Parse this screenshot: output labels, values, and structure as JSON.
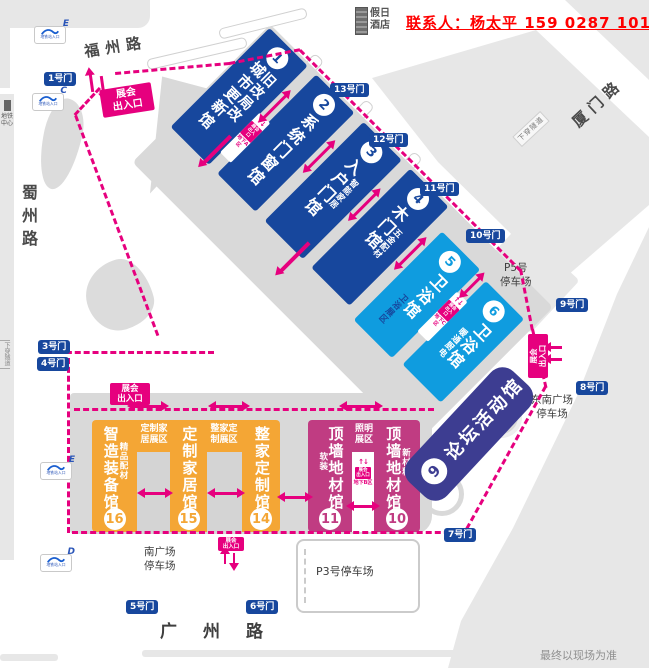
{
  "colors": {
    "hall_dark_blue": "#17479d",
    "hall_light_blue": "#0f9cdf",
    "hall_indigo": "#3d3d91",
    "hall_magenta": "#c03c82",
    "hall_orange": "#f4a635",
    "accent_pink": "#e6007e",
    "gate_blue": "#17479d",
    "contact_red": "#ff0000"
  },
  "contact": {
    "text": "联系人：杨太平 159 0287 1013"
  },
  "hotel": {
    "line1": "假日",
    "line2": "酒店"
  },
  "streets": {
    "fuzhou": "福州路",
    "shuzhou": "蜀州路",
    "guangzhou": "广州路",
    "xiamen": "厦门路",
    "tunnel": "下穿隧道",
    "tunnel_left": "下穿隧道"
  },
  "metro": {
    "center_line1": "地铁",
    "center_line2": "中心",
    "entrance_label": "地铁站入口",
    "stations": [
      {
        "letter": "E"
      },
      {
        "letter": "C"
      },
      {
        "letter": "E"
      },
      {
        "letter": "D"
      }
    ]
  },
  "gates": {
    "g1": "1号门",
    "g3": "3号门",
    "g4": "4号门",
    "g5": "5号门",
    "g6": "6号门",
    "g7": "7号门",
    "g8": "8号门",
    "g9": "9号门",
    "g10": "10号门",
    "g11": "11号门",
    "g12": "12号门",
    "g13": "13号门"
  },
  "halls": {
    "h1": {
      "num": "1",
      "name": "城市更新馆",
      "side": "旧改局改"
    },
    "h2": {
      "num": "2",
      "name": "系统门窗馆"
    },
    "h3": {
      "num": "3",
      "name": "入户门馆",
      "sub": "智能家居"
    },
    "h4": {
      "num": "4",
      "name": "木门馆",
      "sub": "五金配材"
    },
    "h5": {
      "num": "5",
      "name": "卫浴馆",
      "sub": "卫浴展区"
    },
    "h6": {
      "num": "6",
      "name": "卫浴馆",
      "sub": "暖通厨电"
    },
    "h9": {
      "num": "9",
      "name": "论坛活动馆"
    },
    "h10": {
      "num": "10",
      "name": "顶墙地材馆",
      "sub": "新材料"
    },
    "h11": {
      "num": "11",
      "name": "顶墙地材馆",
      "sub": "软装"
    },
    "h14": {
      "num": "14",
      "name": "整家定制馆"
    },
    "h15": {
      "num": "15",
      "name": "定制家居馆"
    },
    "h16": {
      "num": "16",
      "name": "智造装备馆",
      "sub": "精品配材"
    }
  },
  "zones": {
    "z1": {
      "l1": "定制家",
      "l2": "居展区"
    },
    "z2": {
      "l1": "整家定",
      "l2": "制展区"
    },
    "z3": {
      "l1": "照明",
      "l2": "展区"
    }
  },
  "entrance": {
    "l1": "展会",
    "l2": "出入口",
    "ua": "地下A区",
    "ub": "地下B区",
    "uc": "地下C区",
    "arrows": "↑↓"
  },
  "parking": {
    "p5": {
      "l1": "P5号",
      "l2": "停车场"
    },
    "p3": "P3号停车场",
    "south": {
      "l1": "南广场",
      "l2": "停车场"
    },
    "se": {
      "l1": "东南广场",
      "l2": "停车场"
    }
  },
  "footer": "最终以现场为准"
}
